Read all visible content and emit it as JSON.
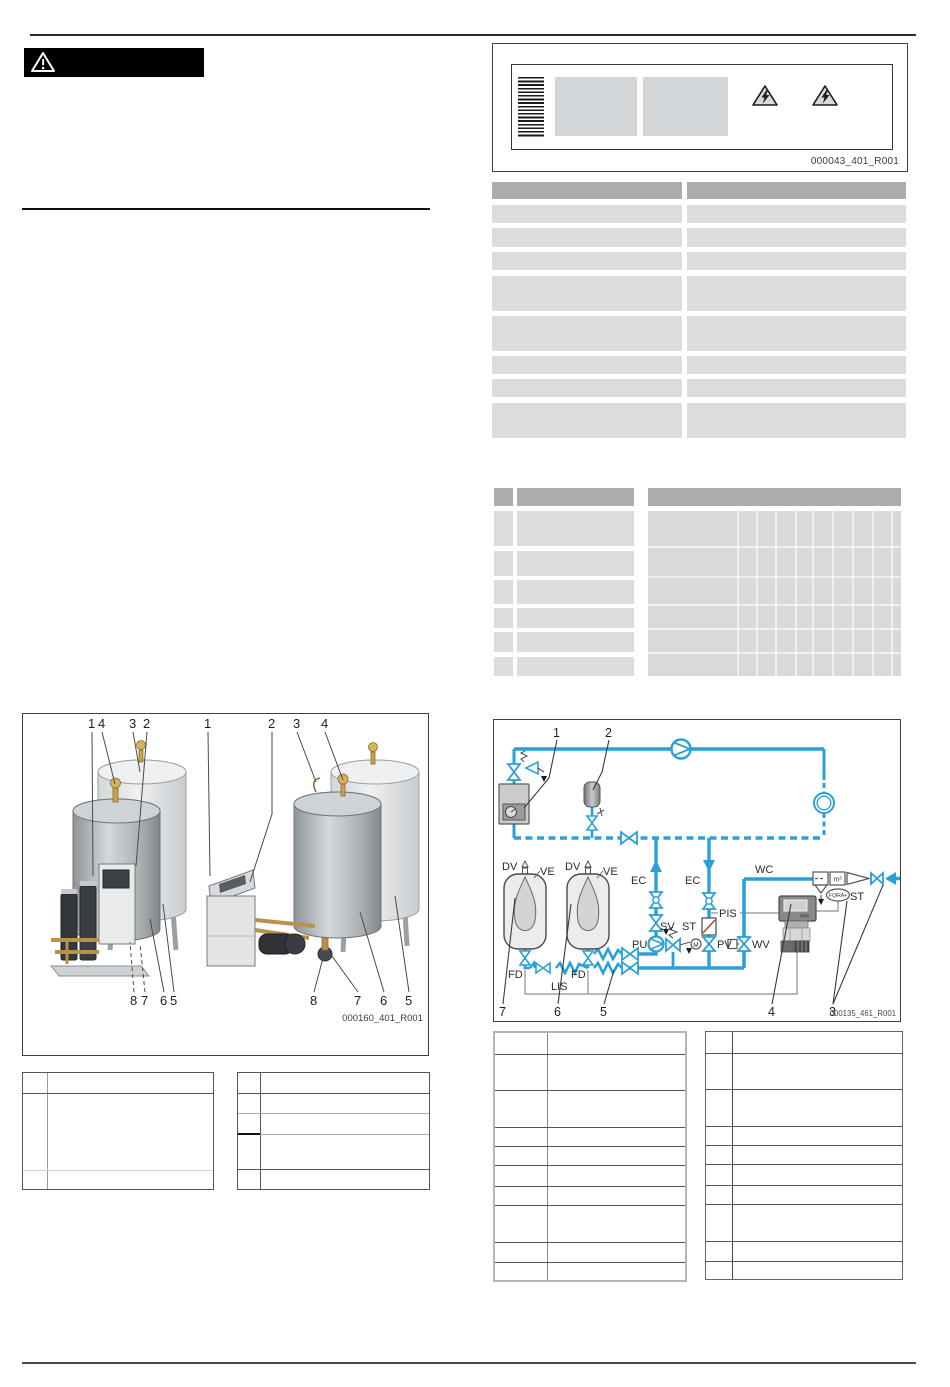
{
  "figures": {
    "nameplate": {
      "caption": "000043_401_R001"
    },
    "tanks": {
      "caption": "000160_401_R001",
      "callouts": {
        "left_top": [
          "1",
          "4",
          "3",
          "2"
        ],
        "right_top": [
          "1",
          "2",
          "3",
          "4"
        ],
        "left_bottom": [
          "8",
          "7",
          "6",
          "5"
        ],
        "right_bottom": [
          "8",
          "7",
          "6",
          "5"
        ]
      }
    },
    "schematic": {
      "caption": "000135_461_R001",
      "labels": {
        "dv1": "DV",
        "dv2": "DV",
        "ve1": "VE",
        "ve2": "VE",
        "ec1": "EC",
        "ec2": "EC",
        "wc": "WC",
        "pis": "PIS",
        "pu": "PU",
        "sv": "SV",
        "st1": "ST",
        "pv": "PV",
        "wv": "WV",
        "st2": "ST",
        "fd1": "FD",
        "fd2": "FD",
        "lis": "LIS",
        "fqira": "FQIRA+",
        "m3": "m³",
        "motor": "M"
      },
      "callouts": {
        "c1": "1",
        "c2": "2",
        "c3": "3",
        "c4": "4",
        "c5": "5",
        "c6": "6",
        "c7": "7"
      }
    }
  },
  "colors": {
    "pipe_blue": "#29a1d8",
    "table_header": "#acacac",
    "table_row": "#dcdcdc"
  }
}
